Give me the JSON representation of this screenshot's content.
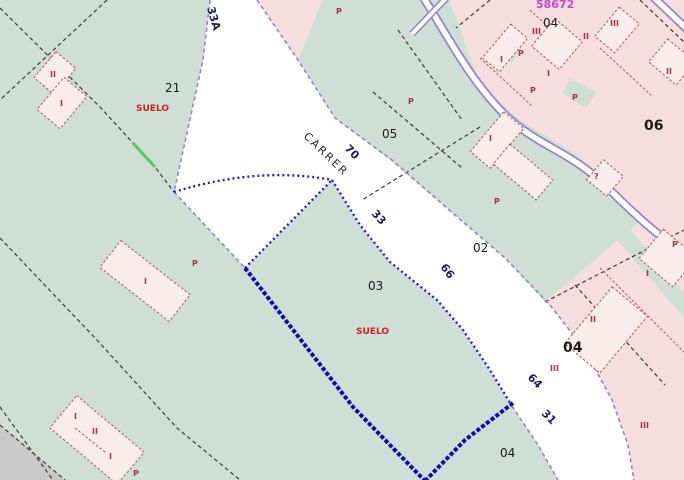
{
  "map": {
    "plan_ref": "58672",
    "street": {
      "name": "CARRER",
      "ref": "33A",
      "numbers": [
        "70",
        "33",
        "66",
        "64",
        "31"
      ]
    },
    "parcels": [
      "21",
      "05",
      "02",
      "03",
      "04",
      "06",
      "04",
      "04"
    ],
    "zone_labels": [
      "SUELO",
      "SUELO"
    ],
    "floors": [
      "II",
      "I",
      "I",
      "I",
      "II",
      "I",
      "P",
      "P",
      "P",
      "P",
      "P",
      "P",
      "P",
      "I",
      "?",
      "P",
      "I",
      "III",
      "II",
      "III",
      "I",
      "I",
      "II",
      "II",
      "III",
      "III",
      "P"
    ],
    "colors": {
      "rustic_green": "#cfdfd6",
      "urban_pink": "#f6dede",
      "building_pink": "#fbecec",
      "building_outline": "#b05548",
      "selection_blue": "#0c0cae",
      "street_edge_purple": "#9184c9",
      "suelo_red": "#cc2222",
      "floor_label_red": "#a03838",
      "ref_magenta": "#cc44cc",
      "street_white": "#ffffff",
      "margin_gray": "#c9c9c9",
      "boundary_dark": "#3a3a3a",
      "highlight_green": "#55cc55"
    }
  }
}
